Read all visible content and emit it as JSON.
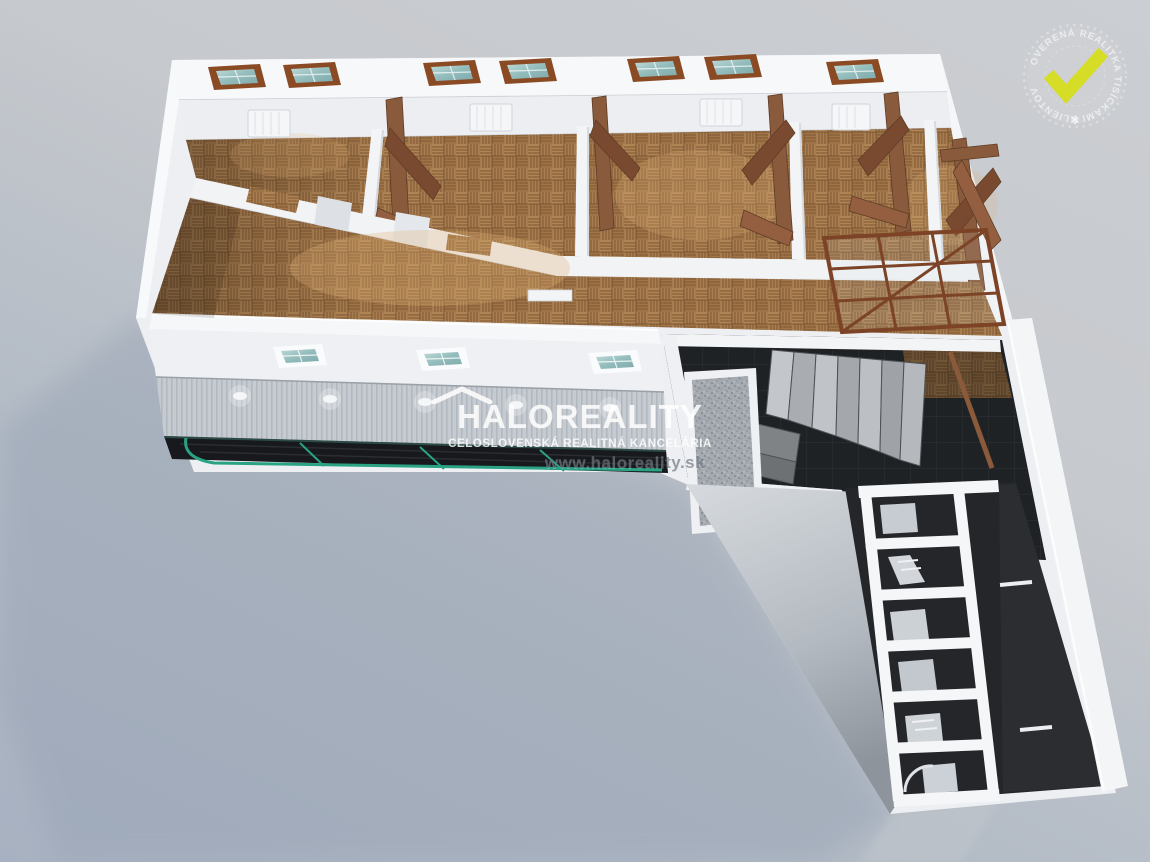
{
  "image": {
    "kind": "3D isometric cutaway floor-plan rendering (real-estate listing visual)",
    "width_px": 1150,
    "height_px": 862
  },
  "watermark": {
    "brand": "HALOREALITY",
    "tagline": "CELOSLOVENSKÁ REALITNÁ KANCELÁRIA",
    "url": "www.haloreality.sk",
    "roof_icon": "roof-chevron-icon"
  },
  "badge": {
    "circular_text": "OVERENÁ REALITKA TISÍCKAMI KLIENTOV",
    "separator_star": "✻",
    "check_icon": "checkmark-icon",
    "check_color": "#d6dd26"
  },
  "palette": {
    "background_top": "#cbced2",
    "background_bottom": "#a7b1c1",
    "wall_white": "#f2f4f6",
    "wall_shadow": "#d5dade",
    "parquet": "#a87e50",
    "parquet_line": "#7f5733",
    "beam_brown": "#8a5a3c",
    "window_frame_brown": "#8a4a24",
    "glass_teal": "#9fc2c2",
    "canopy_green": "#2aa385",
    "dark_floor": "#1d1f22",
    "stair_gray": "#b9bcc0",
    "watermark_white": "rgba(255,255,255,0.85)",
    "url_gray": "#606872"
  },
  "render_features": {
    "top_roof_skylights": 7,
    "front_roof_skylights": 3,
    "facade_spotlights": 5,
    "top_row_rooms": 5,
    "corridor_grid_cells": 6,
    "staircase": 1,
    "canopy_glass_green_frame": 1
  }
}
